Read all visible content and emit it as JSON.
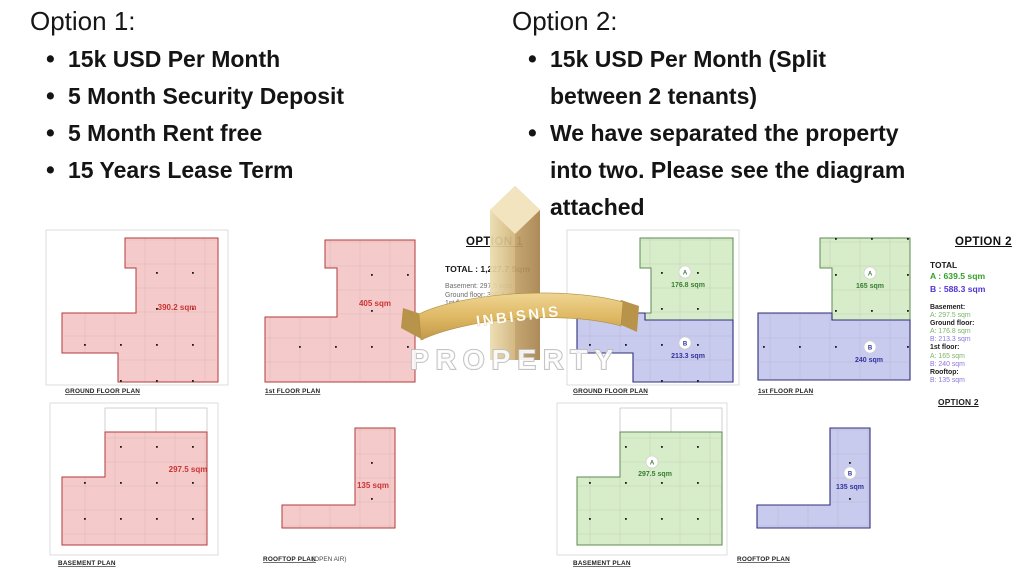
{
  "option1": {
    "heading": "Option 1:",
    "bullets": [
      {
        "lines": [
          "15k USD Per Month"
        ]
      },
      {
        "lines": [
          "5 Month Security Deposit"
        ]
      },
      {
        "lines": [
          "5 Month Rent free"
        ]
      },
      {
        "lines": [
          "15 Years Lease Term"
        ]
      }
    ]
  },
  "option2": {
    "heading": "Option 2:",
    "bullets": [
      {
        "lines": [
          "15k USD Per Month (Split",
          "between 2 tenants)"
        ]
      },
      {
        "lines": [
          "We have separated the property",
          "into two. Please see the diagram",
          "attached"
        ]
      }
    ]
  },
  "summary1": {
    "title": "OPTION 1",
    "total": "TOTAL : 1,227.7 Sqm",
    "lines": [
      "Basement: 297.5 sqm",
      "Ground floor: 390.2 sqm",
      "1st floor: 405 sqm",
      "Rooftop: 135 sqm"
    ]
  },
  "summary2": {
    "title": "OPTION 2",
    "total_label": "TOTAL",
    "total_a": "A : 639.5 sqm",
    "total_b": "B : 588.3 sqm",
    "lines": [
      {
        "text": "Basement:",
        "kind": "label"
      },
      {
        "text": "A: 297.5 sqm",
        "kind": "a"
      },
      {
        "text": "Ground floor:",
        "kind": "label"
      },
      {
        "text": "A: 176.8 sqm",
        "kind": "a"
      },
      {
        "text": "B: 213.3 sqm",
        "kind": "b"
      },
      {
        "text": "1st floor:",
        "kind": "label"
      },
      {
        "text": "A: 165 sqm",
        "kind": "a"
      },
      {
        "text": "B: 240 sqm",
        "kind": "b"
      },
      {
        "text": "Rooftop:",
        "kind": "label"
      },
      {
        "text": "B: 135 sqm",
        "kind": "b"
      }
    ],
    "footer_label": "OPTION 2"
  },
  "plans": {
    "o1_ground": {
      "caption": "GROUND FLOOR PLAN",
      "area": "390.2 sqm"
    },
    "o1_first": {
      "caption": "1st FLOOR PLAN",
      "area": "405 sqm"
    },
    "o1_basement": {
      "caption": "BASEMENT PLAN",
      "area": "297.5 sqm"
    },
    "o1_rooftop": {
      "caption": "ROOFTOP PLAN",
      "caption_note": "(OPEN AIR)",
      "area": "135 sqm"
    },
    "o2_ground": {
      "caption": "GROUND FLOOR PLAN",
      "unit_a": "A",
      "area_a": "176.8 sqm",
      "unit_b": "B",
      "area_b": "213.3 sqm"
    },
    "o2_first": {
      "caption": "1st FLOOR PLAN",
      "unit_a": "A",
      "area_a": "165 sqm",
      "unit_b": "B",
      "area_b": "240 sqm"
    },
    "o2_basement": {
      "caption": "BASEMENT PLAN",
      "unit_a": "A",
      "area_a": "297.5 sqm"
    },
    "o2_rooftop": {
      "caption": "ROOFTOP PLAN",
      "unit_b": "B",
      "area_b": "135 sqm"
    }
  },
  "watermark": {
    "brand": "INBISNIS",
    "brand_sub": "PROPERTY"
  },
  "colors": {
    "option1_fill": "#f5caca",
    "option1_stroke": "#b23a3a",
    "option1_label": "#cb3434",
    "unit_a_fill": "#d7edca",
    "unit_a_stroke": "#5d8a50",
    "unit_a_label": "#3a7d33",
    "unit_b_fill": "#c9cbee",
    "unit_b_stroke": "#2e2e7a",
    "unit_b_label": "#32329b",
    "summary_a": "#33a02c",
    "summary_b": "#5134d2",
    "summary_a_light": "#7cb666",
    "summary_b_light": "#8c78dd",
    "ribbon_gold": "#d9b469"
  }
}
